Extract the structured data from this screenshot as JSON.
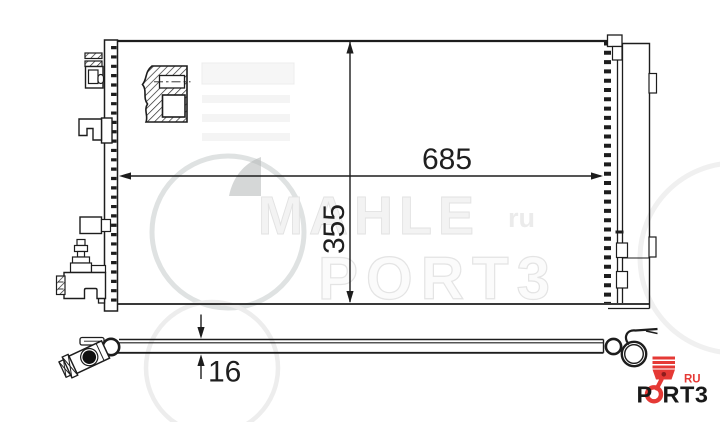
{
  "dims": {
    "width_label": "685",
    "height_label": "355",
    "thickness_label": "16"
  },
  "watermark": {
    "brand": "MAHLE",
    "region": "ru",
    "site": "PORT3"
  },
  "logo": {
    "part_p": "P",
    "part_rt3": "RT3",
    "region": "RU"
  },
  "colors": {
    "line": "#1d1d1d",
    "logo_red": "#e53935",
    "piston_pin_red": "#8e1c1c",
    "watermark_gray": "#ededed",
    "background": "#ffffff"
  }
}
